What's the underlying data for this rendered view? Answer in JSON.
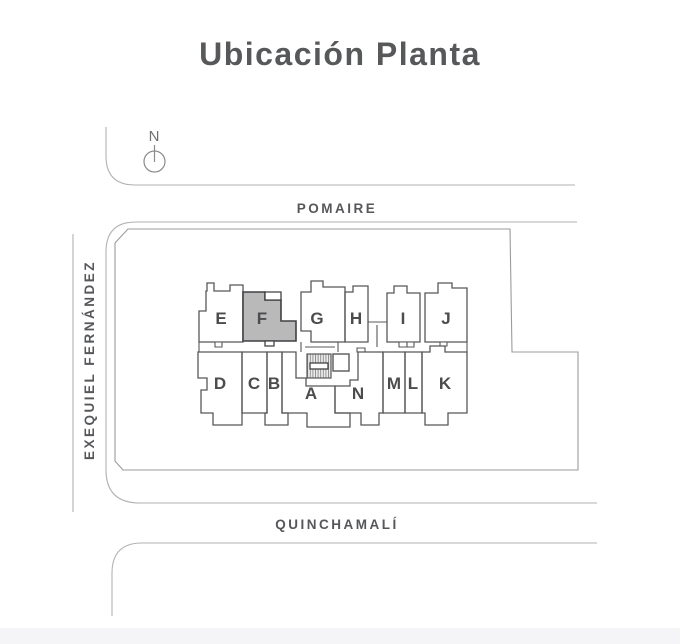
{
  "title": "Ubicación Planta",
  "compass": {
    "label": "N"
  },
  "streets": {
    "top": "POMAIRE",
    "left": "EXEQUIEL FERNÁNDEZ",
    "bottom": "QUINCHAMALÍ"
  },
  "plan": {
    "highlighted_unit": "F",
    "top_row_units": [
      "E",
      "F",
      "G",
      "H",
      "I",
      "J"
    ],
    "bottom_row_units": [
      "D",
      "C",
      "B",
      "A",
      "N",
      "M",
      "L",
      "K"
    ]
  },
  "colors": {
    "title_text": "#57585a",
    "street_text": "#56575a",
    "street_line": "#b2b2b5",
    "plan_line": "#58585a",
    "highlight_fill": "#b9b9ba",
    "highlight_stroke": "#414144",
    "bottom_band": "#f5f5f7"
  }
}
